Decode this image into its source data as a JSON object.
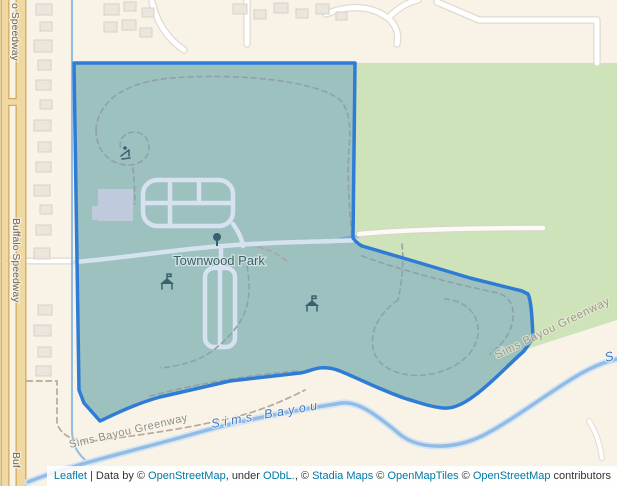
{
  "map": {
    "labels": {
      "townwood_park": "Townwood Park",
      "buffalo_speedway_top": "o Speedway",
      "buffalo_speedway_mid": "Buffalo Speedway",
      "buffalo_speedway_bottom": "Buf",
      "sims_bayou": "Sims Bayou",
      "sims_bayou_partial": "S",
      "greenway_left": "Sims Bayou Greenway",
      "greenway_right": "Sims Bayou Greenway"
    },
    "icons": [
      {
        "name": "playground-icon"
      },
      {
        "name": "tree-icon"
      },
      {
        "name": "picnic-shelter-icon"
      },
      {
        "name": "picnic-shelter-icon"
      }
    ]
  },
  "colors": {
    "cream": "#f8f3e6",
    "green": "#cfe3ba",
    "polygon-stroke": "#2e7cd6",
    "polygon-fill": "rgba(62,130,200,0.35)",
    "primary-road": "#eed9a2",
    "primary-road-casing": "#d4a85a",
    "water": "#93bce4",
    "water-label": "#3d7ac8",
    "park-label": "#3e6066",
    "link": "#0078a8"
  },
  "attribution": {
    "segments": [
      {
        "text": "Leaflet"
      },
      {
        "text": " | Data by © "
      },
      {
        "text": "OpenStreetMap"
      },
      {
        "text": ", under "
      },
      {
        "text": "ODbL."
      },
      {
        "text": ", © "
      },
      {
        "text": "Stadia Maps"
      },
      {
        "text": " © "
      },
      {
        "text": "OpenMapTiles"
      },
      {
        "text": " © "
      },
      {
        "text": "OpenStreetMap"
      },
      {
        "text": " contributors"
      }
    ]
  }
}
